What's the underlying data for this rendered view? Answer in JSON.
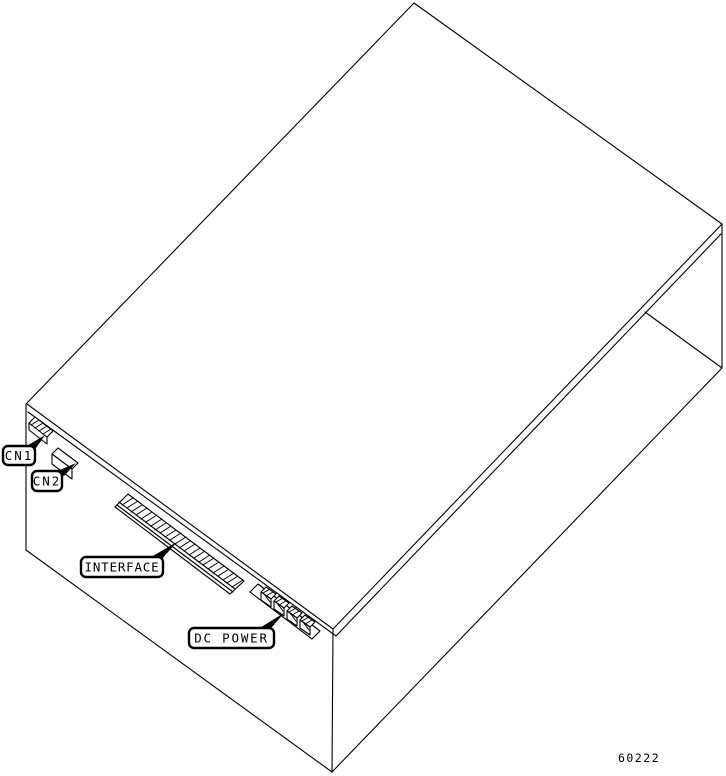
{
  "diagram": {
    "description": "isometric-line-drawing-of-equipment-enclosure-with-connector-panel",
    "callouts": [
      {
        "label": "CN1"
      },
      {
        "label": "CN2"
      },
      {
        "label": "INTERFACE"
      },
      {
        "label": "DC POWER"
      }
    ],
    "figure_number": "60222",
    "colors": {
      "line": "#000000",
      "background": "#ffffff"
    }
  }
}
